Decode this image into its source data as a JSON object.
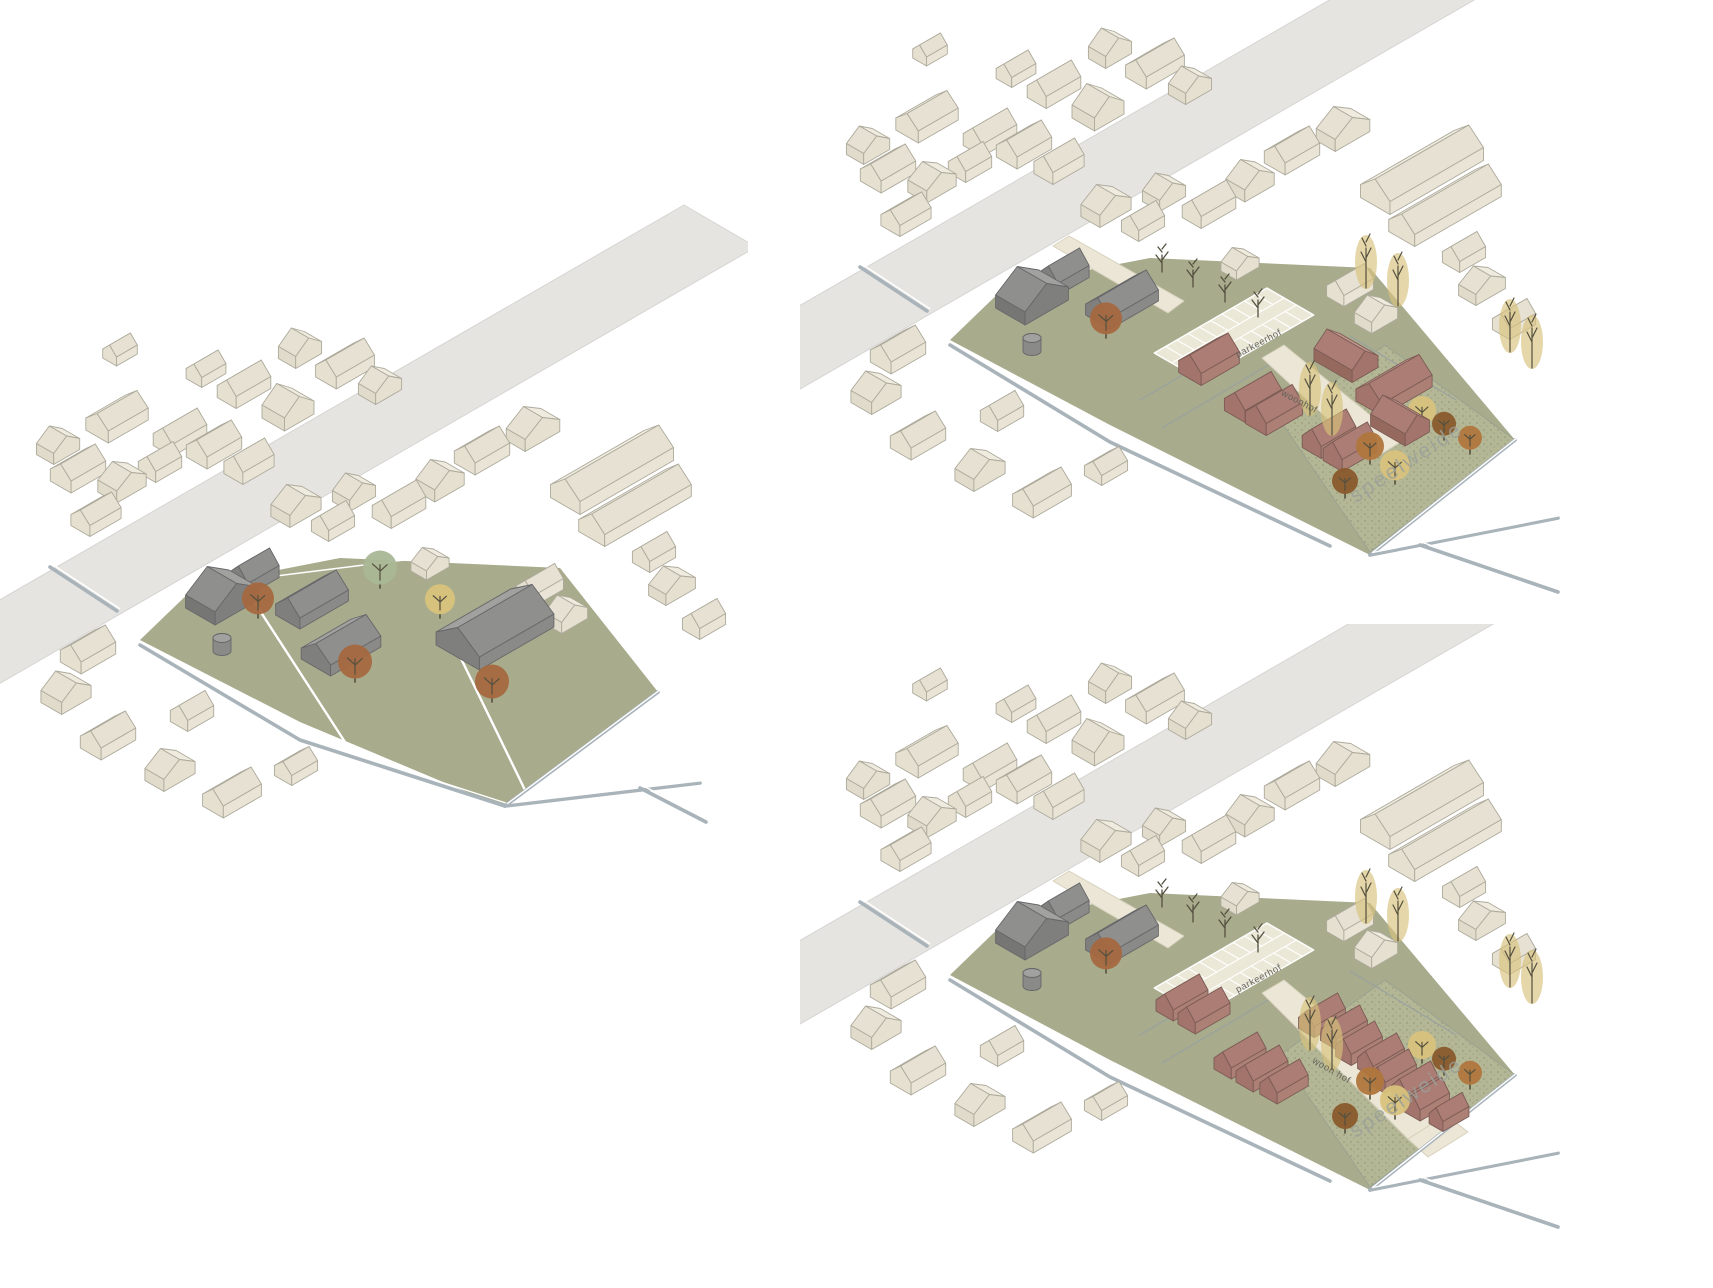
{
  "page": {
    "background": "#ffffff",
    "description_labels": [
      "parkeerhof",
      "woonhof",
      "speelweide"
    ]
  },
  "colors": {
    "context_roof_light": "#efecdf",
    "context_roof_dark": "#e6e1d2",
    "context_wall_sw": "#e0dbca",
    "context_wall_se": "#e9e4d6",
    "context_end": "#e5e0d0",
    "context_outline": "#adaa9c",
    "gray_roof_light": "#a1a19f",
    "gray_roof_dark": "#8f8f8d",
    "gray_wall_sw": "#767674",
    "gray_wall_se": "#8a8a88",
    "gray_end": "#7f7f7d",
    "gray_outline": "#67676a",
    "red_roof_light": "#bf958c",
    "red_roof_dark": "#ab7d74",
    "red_wall_sw": "#96695f",
    "red_wall_se": "#ad8076",
    "red_end": "#a2746b",
    "red_outline": "#7c5c55",
    "road": "#e5e4e1",
    "field": "#a8ab8c",
    "path": "#ebe6d5",
    "parking_bg": "#ece8d8",
    "parking_line": "#ffffff",
    "ditch": "#a9b3ba",
    "divider": "#ffffff",
    "speelweide_bg": "#b4b795",
    "speelweide_dot": "#8e9272",
    "hedge": "#99a29f",
    "tree_rust": "#a5683f",
    "tree_green": "#a9b795",
    "tree_yellow": "#d8c27c",
    "tree_orange": "#b0763d",
    "tree_dark": "#8a5a2c",
    "branch": "#54503f",
    "label_small": "#60605b",
    "label_big": "#9aa09a"
  },
  "panels": [
    {
      "id": "existing-situation",
      "offset": [
        0,
        0
      ],
      "field": "left",
      "farm": "existing",
      "development": null,
      "labels": []
    },
    {
      "id": "variant-1",
      "offset": [
        810,
        -300
      ],
      "field": "right",
      "farm": "retained",
      "development": "v1",
      "labels": [
        {
          "text": "parkeerhof",
          "x": 450,
          "y": 646,
          "rot": -28,
          "size": 9.5,
          "kind": "small"
        },
        {
          "text": "woonhof",
          "x": 488,
          "y": 704,
          "rot": 28,
          "size": 9.5,
          "kind": "small"
        },
        {
          "text": "speelweide",
          "x": 600,
          "y": 768,
          "rot": -33,
          "size": 21,
          "kind": "big"
        }
      ]
    },
    {
      "id": "variant-2",
      "offset": [
        810,
        335
      ],
      "field": "right",
      "farm": "retained",
      "development": "v2",
      "labels": [
        {
          "text": "parkeerhof",
          "x": 450,
          "y": 646,
          "rot": -28,
          "size": 9.5,
          "kind": "small"
        },
        {
          "text": "woon hof",
          "x": 520,
          "y": 738,
          "rot": 30,
          "size": 9.5,
          "kind": "small"
        },
        {
          "text": "speelweide",
          "x": 600,
          "y": 768,
          "rot": -33,
          "size": 21,
          "kind": "big"
        }
      ]
    }
  ],
  "scene": {
    "road": [
      [
        -146,
        684
      ],
      [
        684,
        205
      ],
      [
        756,
        247
      ],
      [
        -74,
        726
      ]
    ],
    "ditch_nw": [
      [
        50,
        567
      ],
      [
        117,
        611
      ]
    ],
    "field_left": [
      [
        140,
        640
      ],
      [
        196,
        586
      ],
      [
        340,
        558
      ],
      [
        560,
        568
      ],
      [
        658,
        692
      ],
      [
        505,
        808
      ],
      [
        300,
        722
      ]
    ],
    "field_right": [
      [
        140,
        640
      ],
      [
        196,
        586
      ],
      [
        340,
        558
      ],
      [
        560,
        568
      ],
      [
        705,
        740
      ],
      [
        560,
        855
      ],
      [
        300,
        725
      ]
    ],
    "dividers_left": [
      [
        [
          253,
          600
        ],
        [
          345,
          742
        ]
      ],
      [
        [
          452,
          640
        ],
        [
          525,
          790
        ]
      ]
    ],
    "ditches_left": [
      [
        [
          140,
          645
        ],
        [
          300,
          740
        ],
        [
          505,
          806
        ]
      ],
      [
        [
          505,
          806
        ],
        [
          700,
          783
        ]
      ],
      [
        [
          658,
          692
        ],
        [
          505,
          806
        ]
      ],
      [
        [
          640,
          788
        ],
        [
          706,
          822
        ]
      ]
    ],
    "ditches_right": [
      [
        [
          140,
          645
        ],
        [
          300,
          742
        ],
        [
          520,
          846
        ]
      ],
      [
        [
          705,
          740
        ],
        [
          560,
          855
        ]
      ],
      [
        [
          560,
          855
        ],
        [
          748,
          818
        ]
      ],
      [
        [
          610,
          845
        ],
        [
          748,
          892
        ]
      ]
    ],
    "speelweide_poly": [
      [
        470,
        720
      ],
      [
        575,
        645
      ],
      [
        705,
        740
      ],
      [
        560,
        852
      ]
    ],
    "hedges": [
      [
        [
          330,
          700
        ],
        [
          432,
          640
        ]
      ],
      [
        [
          352,
          728
        ],
        [
          460,
          664
        ]
      ],
      [
        [
          540,
          636
        ],
        [
          646,
          700
        ]
      ]
    ],
    "driveway": [
      [
        243,
        546
      ],
      [
        259,
        536
      ],
      [
        374,
        601
      ],
      [
        358,
        613
      ]
    ],
    "lane_v1": [
      [
        452,
        658
      ],
      [
        474,
        645
      ],
      [
        592,
        741
      ],
      [
        562,
        760
      ]
    ],
    "lane_v2": [
      [
        452,
        658
      ],
      [
        474,
        645
      ],
      [
        636,
        780
      ],
      [
        598,
        804
      ]
    ],
    "lane_v2_end": [
      [
        598,
        804
      ],
      [
        636,
        780
      ],
      [
        658,
        797
      ],
      [
        618,
        822
      ]
    ],
    "parking": {
      "cx": 424,
      "cy": 634,
      "w": 130,
      "d": 54,
      "stall": 13,
      "aisle": 7
    },
    "context_buildings": [
      [
        117,
        425,
        46,
        26,
        12,
        11,
        "u"
      ],
      [
        78,
        477,
        40,
        24,
        12,
        11,
        "u"
      ],
      [
        122,
        489,
        34,
        22,
        12,
        10,
        "v"
      ],
      [
        160,
        470,
        30,
        20,
        11,
        10,
        "u"
      ],
      [
        180,
        441,
        40,
        22,
        12,
        11,
        "u"
      ],
      [
        214,
        453,
        40,
        24,
        12,
        11,
        "u"
      ],
      [
        249,
        470,
        36,
        22,
        12,
        11,
        "u"
      ],
      [
        288,
        416,
        34,
        26,
        13,
        13,
        "v"
      ],
      [
        244,
        393,
        40,
        22,
        12,
        11,
        "u"
      ],
      [
        206,
        376,
        28,
        18,
        10,
        9,
        "u"
      ],
      [
        300,
        356,
        30,
        20,
        12,
        11,
        "v"
      ],
      [
        345,
        372,
        44,
        24,
        12,
        11,
        "u"
      ],
      [
        380,
        392,
        30,
        20,
        11,
        10,
        "v"
      ],
      [
        120,
        356,
        24,
        16,
        9,
        8,
        "u"
      ],
      [
        58,
        452,
        30,
        20,
        11,
        10,
        "v"
      ],
      [
        96,
        522,
        36,
        22,
        11,
        10,
        "u"
      ],
      [
        88,
        658,
        40,
        24,
        12,
        11,
        "u"
      ],
      [
        66,
        700,
        34,
        24,
        12,
        11,
        "v"
      ],
      [
        108,
        744,
        40,
        24,
        12,
        11,
        "u"
      ],
      [
        170,
        777,
        36,
        22,
        12,
        11,
        "v"
      ],
      [
        232,
        801,
        44,
        24,
        12,
        11,
        "u"
      ],
      [
        296,
        773,
        30,
        20,
        10,
        9,
        "u"
      ],
      [
        192,
        719,
        30,
        20,
        11,
        10,
        "u"
      ],
      [
        296,
        513,
        36,
        22,
        12,
        11,
        "v"
      ],
      [
        333,
        529,
        30,
        20,
        11,
        10,
        "u"
      ],
      [
        354,
        499,
        30,
        20,
        11,
        10,
        "v"
      ],
      [
        399,
        513,
        40,
        22,
        12,
        11,
        "u"
      ],
      [
        440,
        488,
        34,
        22,
        12,
        11,
        "v"
      ],
      [
        482,
        459,
        40,
        24,
        12,
        11,
        "u"
      ],
      [
        533,
        436,
        40,
        22,
        12,
        12,
        "v"
      ],
      [
        612,
        479,
        108,
        34,
        13,
        14,
        "u"
      ],
      [
        635,
        514,
        100,
        30,
        12,
        13,
        "u"
      ],
      [
        430,
        569,
        26,
        18,
        9,
        8,
        "v"
      ],
      [
        540,
        593,
        34,
        20,
        11,
        10,
        "u"
      ],
      [
        566,
        621,
        30,
        20,
        11,
        10,
        "v"
      ],
      [
        654,
        560,
        30,
        20,
        11,
        10,
        "u"
      ],
      [
        672,
        592,
        34,
        20,
        11,
        10,
        "v"
      ],
      [
        704,
        627,
        30,
        20,
        11,
        10,
        "u"
      ]
    ],
    "farm_retained": [
      [
        222,
        604,
        50,
        34,
        13,
        16,
        "v"
      ],
      [
        254,
        581,
        36,
        22,
        12,
        12,
        "u"
      ],
      [
        312,
        608,
        56,
        28,
        11,
        13,
        "u"
      ]
    ],
    "farm_extra_existing": [
      [
        341,
        653,
        58,
        34,
        11,
        13,
        "u"
      ],
      [
        495,
        636,
        86,
        50,
        13,
        17,
        "u"
      ]
    ],
    "silo": {
      "x": 222,
      "y": 651,
      "r": 9,
      "h": 13
    },
    "dev_v1": [
      [
        399,
        668,
        44,
        26,
        12,
        12,
        "u"
      ],
      [
        443,
        706,
        42,
        24,
        12,
        12,
        "u"
      ],
      [
        464,
        719,
        42,
        24,
        12,
        12,
        "u"
      ],
      [
        519,
        743,
        40,
        22,
        12,
        12,
        "u"
      ],
      [
        540,
        756,
        40,
        22,
        12,
        12,
        "u"
      ],
      [
        536,
        664,
        30,
        44,
        12,
        12,
        "v"
      ],
      [
        584,
        694,
        58,
        30,
        12,
        13,
        "u"
      ],
      [
        590,
        729,
        28,
        40,
        12,
        12,
        "v"
      ]
    ],
    "dev_v2": [
      [
        372,
        671,
        40,
        20,
        11,
        11,
        "u"
      ],
      [
        394,
        684,
        40,
        20,
        11,
        11,
        "u"
      ],
      [
        430,
        729,
        40,
        20,
        11,
        11,
        "u"
      ],
      [
        452,
        742,
        40,
        20,
        11,
        11,
        "u"
      ],
      [
        474,
        755,
        36,
        20,
        11,
        11,
        "u"
      ],
      [
        512,
        689,
        36,
        18,
        11,
        11,
        "u"
      ],
      [
        534,
        701,
        36,
        18,
        11,
        11,
        "u"
      ],
      [
        549,
        717,
        36,
        18,
        11,
        11,
        "u"
      ],
      [
        571,
        729,
        36,
        18,
        11,
        11,
        "u"
      ],
      [
        583,
        745,
        36,
        18,
        11,
        11,
        "u"
      ],
      [
        605,
        757,
        36,
        18,
        11,
        11,
        "u"
      ],
      [
        617,
        773,
        34,
        18,
        11,
        11,
        "u"
      ],
      [
        639,
        785,
        30,
        16,
        10,
        10,
        "u"
      ]
    ],
    "trees_left": [
      [
        258,
        612,
        "rust",
        16
      ],
      [
        355,
        676,
        "rust",
        17
      ],
      [
        492,
        696,
        "rust",
        17
      ],
      [
        380,
        582,
        "green",
        17
      ],
      [
        440,
        612,
        "yellow",
        15
      ]
    ],
    "farm_tree_right": [
      296,
      632,
      "rust",
      16
    ],
    "bare_trees": [
      [
        352,
        572
      ],
      [
        383,
        587
      ],
      [
        415,
        602
      ],
      [
        448,
        617
      ]
    ],
    "poplars": [
      [
        556,
        588
      ],
      [
        588,
        606
      ],
      [
        700,
        652
      ],
      [
        722,
        668
      ],
      [
        500,
        715
      ],
      [
        522,
        735
      ]
    ],
    "orchard": [
      [
        560,
        758,
        "orange",
        14
      ],
      [
        585,
        778,
        "yellow",
        15
      ],
      [
        535,
        792,
        "dark",
        13
      ],
      [
        612,
        722,
        "yellow",
        14
      ],
      [
        634,
        734,
        "dark",
        12
      ],
      [
        660,
        748,
        "orange",
        12
      ]
    ]
  }
}
